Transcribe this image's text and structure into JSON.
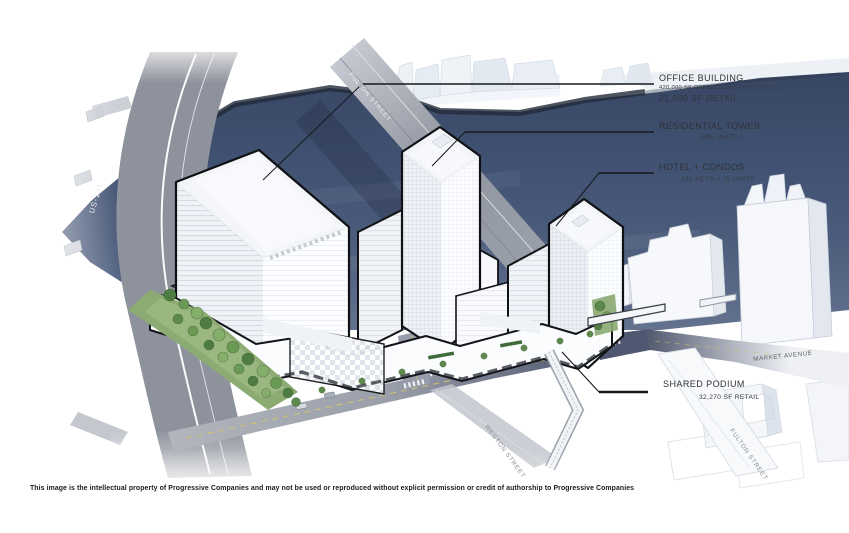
{
  "annotations": {
    "office": {
      "title": "OFFICE BUILDING",
      "line1": "420,000 SF OFFICE [1,600 EMPLOYEES]",
      "line2": "21,000 SF RETAIL"
    },
    "residential": {
      "title": "RESIDENTIAL TOWER",
      "line1": "595 UNITS"
    },
    "hotel": {
      "title": "HOTEL + CONDOS",
      "line1": "130 KEYS + 76 UNITS"
    },
    "podium": {
      "title": "SHARED PODIUM",
      "line1": "32,270 SF RETAIL"
    }
  },
  "streets": {
    "highway": "US-131",
    "fulton_bridge": "FULTON STREET",
    "market": "MARKET AVENUE",
    "weston": "WESTON STREET",
    "fulton_south": "FULTON STREET"
  },
  "footer": {
    "copyright": "This image is the intellectual property of Progressive Companies and may not be used or reproduced without explicit permission or credit of authorship to Progressive Companies"
  },
  "palette": {
    "river": "#46587a",
    "highway": "#8e929c",
    "outline": "#101114",
    "ink": "#303338",
    "lawn": "#8cab72",
    "street_dark": "#4f5870"
  }
}
